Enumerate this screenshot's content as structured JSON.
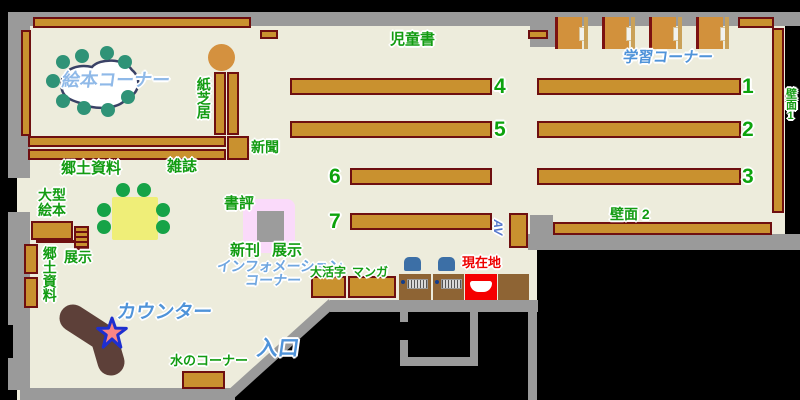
{
  "map": {
    "title": "library floor map",
    "labels": {
      "jidosho": "児童書",
      "ehon_corner": "絵本コーナー",
      "kamishibai": "紙芝居",
      "shinbun": "新聞",
      "kyodo_top": "郷土資料",
      "zasshi": "雑誌",
      "gakushu_corner": "学習コーナー",
      "hekimen1": "壁面1",
      "hekimen2": "壁面 2",
      "ogata_ehon": "大型絵本",
      "tenji_left": "展示",
      "kyodo_left": "郷土資料",
      "shohyo": "書評",
      "shinkan": "新刊",
      "tenji_center": "展示",
      "information_line1": "インフォメーション",
      "information_line2": "コーナー",
      "counter": "カウンター",
      "mizu_corner": "水のコーナー",
      "iriguchi": "入口",
      "daikatsuji": "大活字",
      "manga": "マンガ",
      "genzaichi": "現在地",
      "av": "AV"
    },
    "shelf_numbers": [
      "1",
      "2",
      "3",
      "4",
      "5",
      "6",
      "7"
    ],
    "colors": {
      "floor": "#edecdc",
      "wall": "#9a9a9a",
      "shelf_fill": "#c9912f",
      "shelf_border": "#6e0f10",
      "label_green": "#129c12",
      "label_blue": "#4f93d9",
      "you_are_here_red": "#f50000",
      "counter_brown": "#5d4039",
      "star_fill": "#fa8585",
      "star_stroke": "#1d2fd0"
    }
  }
}
